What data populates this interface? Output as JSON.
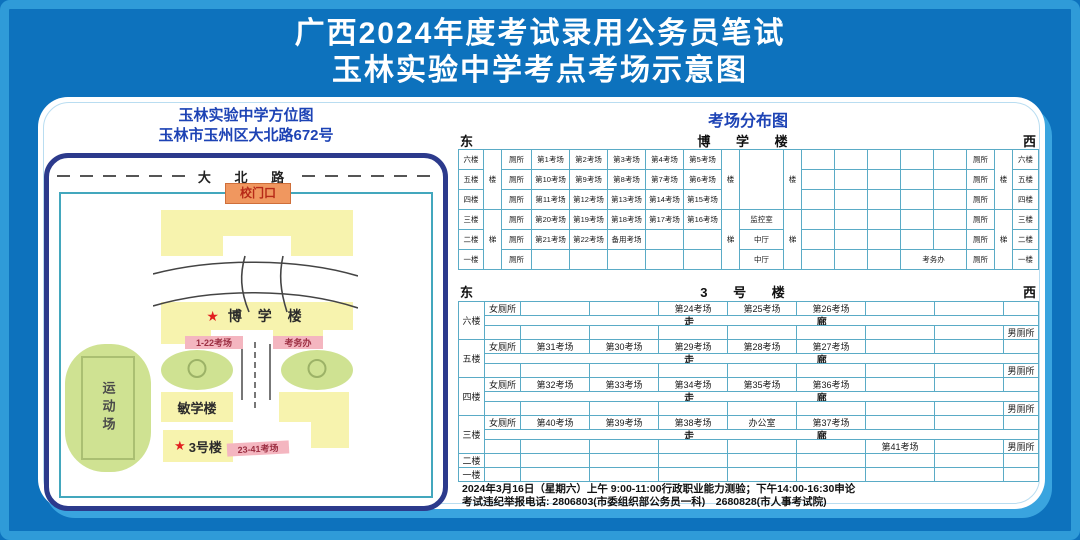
{
  "title": {
    "line1": "广西2024年度考试录用公务员笔试",
    "line2": "玉林实验中学考点考场示意图"
  },
  "map": {
    "title": "玉林实验中学方位图",
    "subtitle": "玉林市玉州区大北路672号",
    "road": "大 北 路",
    "gate": "校门口",
    "boxue_star": "★",
    "boxue_name": "博 学 楼",
    "boxue_rooms": "1-22考场",
    "exam_office": "考务办",
    "minxue_name": "敏学楼",
    "no3_star": "★",
    "no3_name": "3号楼",
    "no3_rooms": "23-41考场",
    "sports": "运动场"
  },
  "dist": {
    "title": "考场分布图",
    "east": "东",
    "west": "西",
    "b1": {
      "name": "博 学 楼",
      "floors": [
        "六楼",
        "五楼",
        "四楼",
        "三楼",
        "二楼",
        "一楼"
      ],
      "stair_top": "楼",
      "stair_bottom": "梯",
      "toilet": "厕所",
      "left_rooms": [
        [
          "第1考场",
          "第2考场",
          "第3考场",
          "第4考场",
          "第5考场"
        ],
        [
          "第10考场",
          "第9考场",
          "第8考场",
          "第7考场",
          "第6考场"
        ],
        [
          "第11考场",
          "第12考场",
          "第13考场",
          "第14考场",
          "第15考场"
        ],
        [
          "第20考场",
          "第19考场",
          "第18考场",
          "第17考场",
          "第16考场"
        ],
        [
          "第21考场",
          "第22考场",
          "备用考场",
          "",
          ""
        ],
        [
          "",
          "",
          "",
          "",
          ""
        ]
      ],
      "middle": [
        "",
        "",
        "",
        "监控室",
        "中厅",
        "中厅"
      ],
      "office": "考务办"
    },
    "b2": {
      "name": "3 号 楼",
      "corridor_left": "走",
      "corridor_right": "廊",
      "floors": [
        {
          "label": "六楼",
          "top": [
            "女厕所",
            "",
            "",
            "第24考场",
            "第25考场",
            "第26考场",
            "",
            "",
            ""
          ],
          "bottom": [
            "",
            "",
            "",
            "",
            "",
            "",
            "",
            "",
            "男厕所"
          ]
        },
        {
          "label": "五楼",
          "top": [
            "女厕所",
            "第31考场",
            "第30考场",
            "第29考场",
            "第28考场",
            "第27考场",
            "",
            "",
            ""
          ],
          "bottom": [
            "",
            "",
            "",
            "",
            "",
            "",
            "",
            "",
            "男厕所"
          ]
        },
        {
          "label": "四楼",
          "top": [
            "女厕所",
            "第32考场",
            "第33考场",
            "第34考场",
            "第35考场",
            "第36考场",
            "",
            "",
            ""
          ],
          "bottom": [
            "",
            "",
            "",
            "",
            "",
            "",
            "",
            "",
            "男厕所"
          ]
        },
        {
          "label": "三楼",
          "top": [
            "女厕所",
            "第40考场",
            "第39考场",
            "第38考场",
            "办公室",
            "第37考场",
            "",
            "",
            ""
          ],
          "bottom": [
            "",
            "",
            "",
            "",
            "",
            "",
            "第41考场",
            "",
            "男厕所"
          ]
        }
      ],
      "simple_floors": [
        "二楼",
        "一楼"
      ]
    }
  },
  "footer": {
    "line1": "2024年3月16日（星期六）上午 9:00-11:00行政职业能力测验；下午14:00-16:30申论",
    "line2": "考试违纪举报电话: 2806803(市委组织部公务员一科)　2680828(市人事考试院)"
  },
  "colors": {
    "background": "#0d72bd",
    "frame_light_blue": "#2f9bd8",
    "panel_shadow": "#39a4df",
    "heading_blue": "#1d43b5",
    "table_border": "#5aabc6",
    "building_yellow": "#f7f3ae",
    "label_pink": "#f4b6c0",
    "gate_orange": "#f0975f",
    "tree_green": "#cfe292",
    "map_border_navy": "#2c3a8c",
    "star_red": "#e21f1f",
    "title_white": "#ffffff"
  }
}
